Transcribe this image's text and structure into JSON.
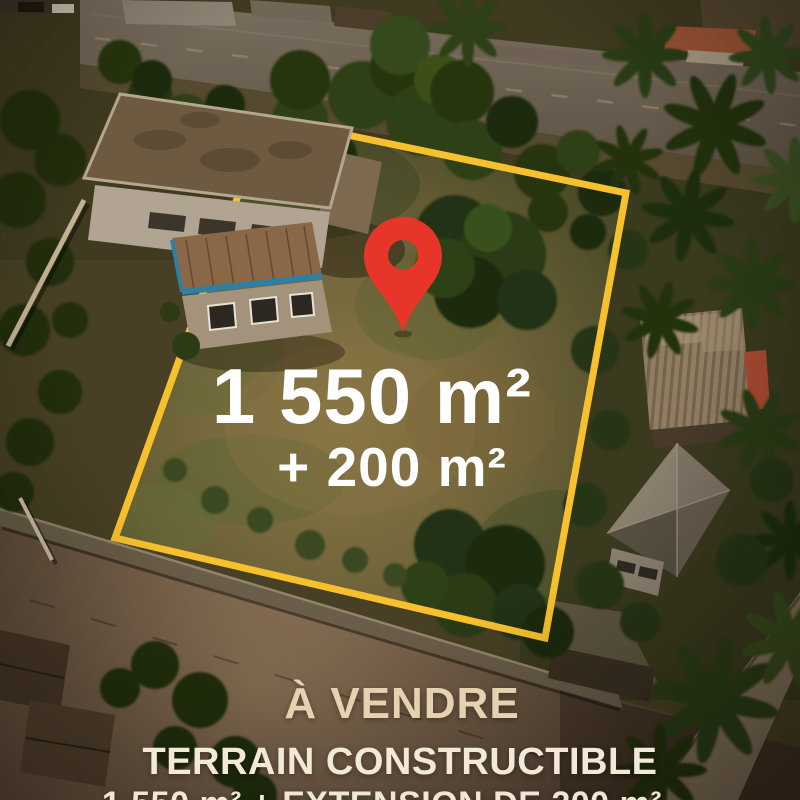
{
  "overlay": {
    "area_main": "1 550 m²",
    "area_extension": "+ 200 m²"
  },
  "footer": {
    "title": "À VENDRE",
    "subtitle": "TERRAIN CONSTRUCTIBLE",
    "details": "1 550 m² + EXTENSION DE 200 m²"
  },
  "icons": {
    "pin": "map-location-pin",
    "boundary": "plot-boundary-outline"
  },
  "colors": {
    "boundary": "#F7C12E",
    "pin": "#E8352A",
    "area_text": "#FFFFFF",
    "title": "#E6D2B0",
    "subtitle": "#F2E9D8",
    "details": "#EFE6D6"
  }
}
